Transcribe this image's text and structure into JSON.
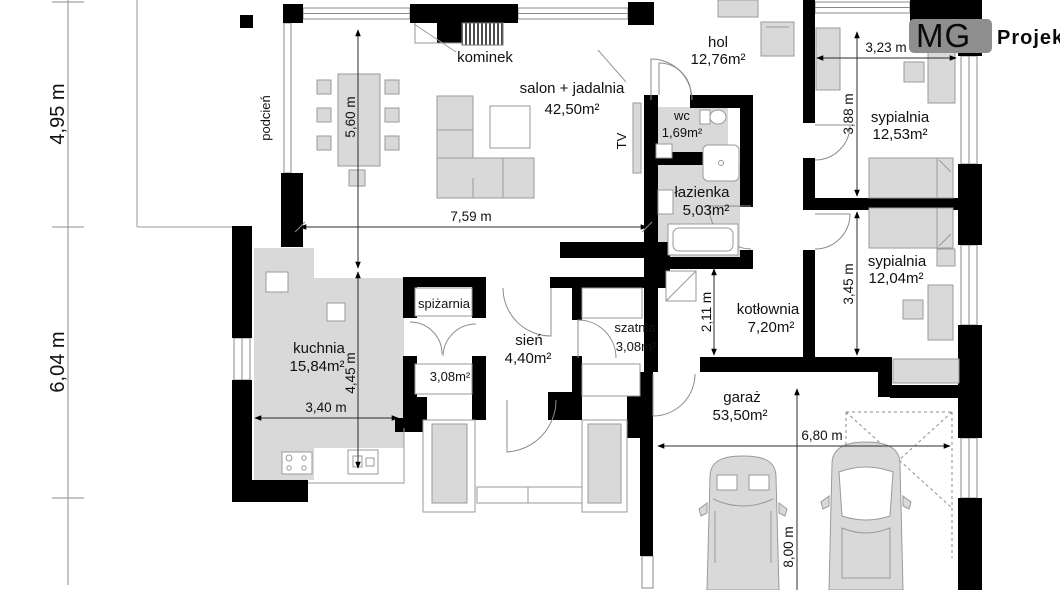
{
  "logo": {
    "mg": "MG",
    "projekt": "Projekt",
    "bg_color": "#8e8e8e"
  },
  "colors": {
    "wall": "#000000",
    "furniture": "#d9d9d9",
    "line": "#9a9a9a",
    "dim": "#2b2b2b"
  },
  "rooms": {
    "salon": {
      "name": "salon + jadalnia",
      "area": "42,50m²"
    },
    "hol": {
      "name": "hol",
      "area": "12,76m²"
    },
    "wc": {
      "name": "wc",
      "area": "1,69m²"
    },
    "lazienka": {
      "name": "łazienka",
      "area": "5,03m²"
    },
    "sypialnia1": {
      "name": "sypialnia",
      "area": "12,53m²"
    },
    "sypialnia2": {
      "name": "sypialnia",
      "area": "12,04m²"
    },
    "kotlownia": {
      "name": "kotłownia",
      "area": "7,20m²"
    },
    "kuchnia": {
      "name": "kuchnia",
      "area": "15,84m²"
    },
    "spizarnia": {
      "name": "spiżarnia",
      "area": "3,08m²"
    },
    "sien": {
      "name": "sień",
      "area": "4,40m²"
    },
    "szatnia": {
      "name": "szatnia",
      "area": "3,08m²"
    },
    "garaz": {
      "name": "garaż",
      "area": "53,50m²"
    }
  },
  "labels": {
    "podcien": "podcień",
    "kominek": "kominek",
    "tv": "TV"
  },
  "dimensions": {
    "left_top": "4,95 m",
    "left_bottom": "6,04 m",
    "salon_width": "7,59 m",
    "salon_height": "5,60 m",
    "kuchnia_height": "4,45 m",
    "kuchnia_width": "3,40 m",
    "sypialnia1_width": "3,23 m",
    "sypialnia1_height": "3,88 m",
    "sypialnia2_height": "3,45 m",
    "kotlownia_height": "2,11 m",
    "garaz_width": "6,80 m",
    "garaz_height": "8,00 m"
  }
}
